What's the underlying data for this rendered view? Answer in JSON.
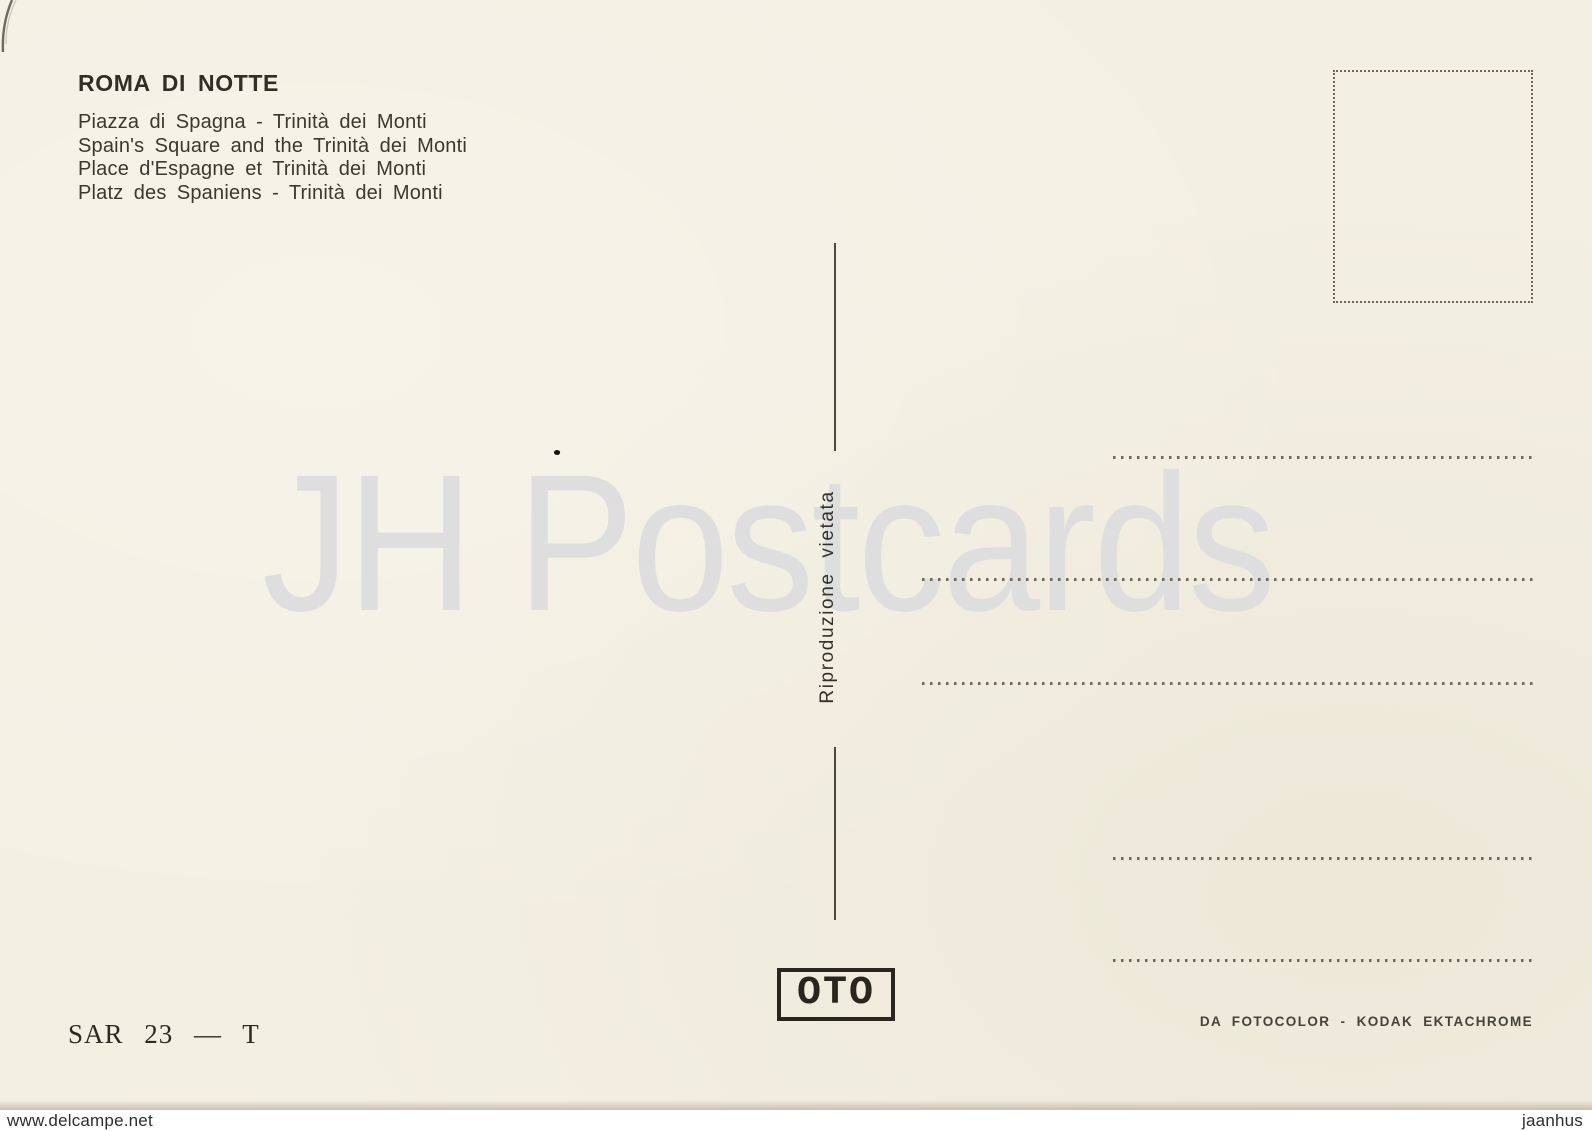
{
  "postcard": {
    "title": "ROMA DI NOTTE",
    "captions": [
      "Piazza di Spagna - Trinità dei Monti",
      "Spain's Square and the Trinità dei Monti",
      "Place d'Espagne et Trinità dei Monti",
      "Platz des Spaniens - Trinità dei Monti"
    ],
    "reproduction_notice": "Riproduzione  vietata",
    "publisher_logo": "OTO",
    "series_code": "SAR 23 — T",
    "film_credit": "DA FOTOCOLOR - KODAK EKTACHROME"
  },
  "watermarks": {
    "center": "JH Postcards",
    "site": "www.delcampe.net",
    "seller": "jaanhus"
  },
  "colors": {
    "card_background": "#f3efe2",
    "ink": "#34312a",
    "dotted_line": "#6f675a",
    "center_watermark": "#dedede",
    "footer_background": "#ffffff"
  }
}
